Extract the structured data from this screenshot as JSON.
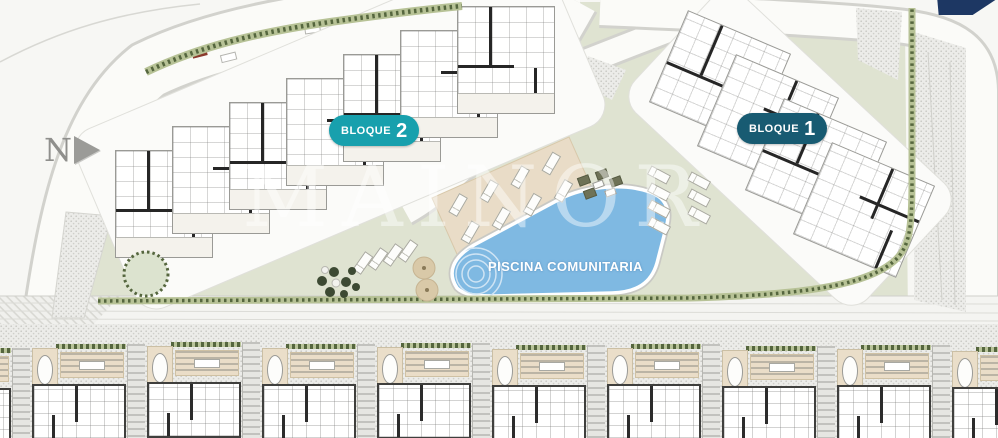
{
  "north_indicator": {
    "label": "N"
  },
  "watermark": {
    "text": "MAINOR"
  },
  "badges": [
    {
      "id": "bloque-2",
      "label": "BLOQUE",
      "number": "2",
      "color": "#18a0ad"
    },
    {
      "id": "bloque-1",
      "label": "BLOQUE",
      "number": "1",
      "color": "#185b72"
    }
  ],
  "pool": {
    "label": "PISCINA COMUNITARIA",
    "water_color": "#7fb9e2"
  },
  "site": {
    "lawn_color": "#dfe3d1",
    "hedge_color": "#55663e",
    "deck_color": "#e9dcc7",
    "road_color": "#ffffff",
    "gravel_color": "#ecece9",
    "corner_ribbon_color": "#1d3763"
  },
  "buildings": {
    "bloque2": {
      "name": "Bloque 2",
      "unit_count": 7
    },
    "bloque1": {
      "name": "Bloque 1",
      "unit_count": 4
    }
  },
  "townhouses": {
    "full_units": 9,
    "partial_units": 1
  }
}
